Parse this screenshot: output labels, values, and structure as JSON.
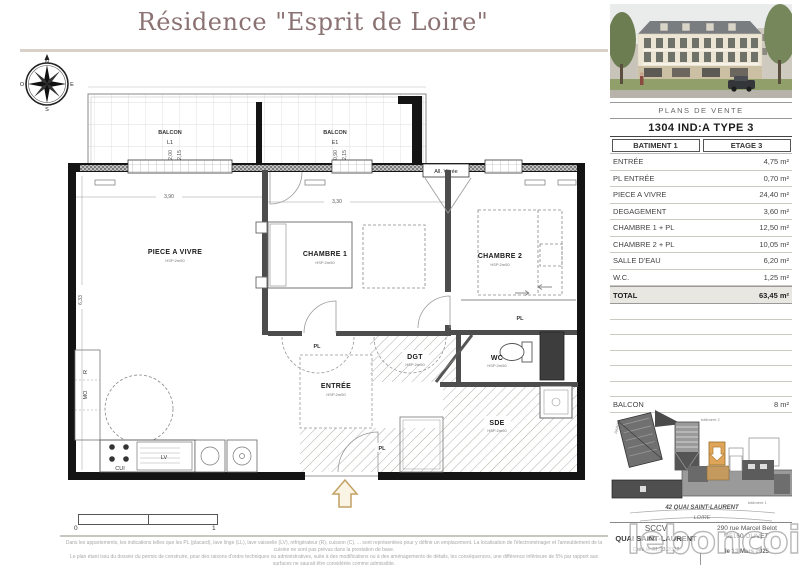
{
  "title": "Résidence \"Esprit de Loire\"",
  "compass": {
    "n": "N",
    "e": "E",
    "s": "S",
    "o": "O"
  },
  "plan": {
    "balcon_left": {
      "label": "BALCON",
      "code": "L1",
      "dim_a": "2,00",
      "dim_b": "2,15"
    },
    "balcon_right": {
      "label": "BALCON",
      "code": "E1",
      "dim_a": "0,90",
      "dim_b": "2,15"
    },
    "all_vitree": "All. Vitrée",
    "hsp": "HSP:2m50",
    "rooms": {
      "piece_a_vivre": "PIECE A VIVRE",
      "chambre1": "CHAMBRE 1",
      "chambre2": "CHAMBRE 2",
      "entree": "ENTRÉE",
      "dgt": "DGT",
      "wc": "WC",
      "sde": "SDE",
      "pl": "PL",
      "cui": "CUI",
      "lv": "LV",
      "mo": "MO",
      "r": "R"
    },
    "dims": {
      "d390": "3,90",
      "d633": "6,33",
      "d330": "3,30"
    }
  },
  "panel": {
    "header": "PLANS DE VENTE",
    "unit": "1304 IND:A TYPE 3",
    "batiment": "BATIMENT 1",
    "etage": "ETAGE 3",
    "rows": [
      {
        "label": "ENTRÉE",
        "value": "4,75 m²"
      },
      {
        "label": "PL ENTRÉE",
        "value": "0,70 m²"
      },
      {
        "label": "PIECE A VIVRE",
        "value": "24,40 m²"
      },
      {
        "label": "DEGAGEMENT",
        "value": "3,60 m²"
      },
      {
        "label": "CHAMBRE 1 + PL",
        "value": "12,50 m²"
      },
      {
        "label": "CHAMBRE 2 + PL",
        "value": "10,05 m²"
      },
      {
        "label": "SALLE D'EAU",
        "value": "6,20 m²"
      },
      {
        "label": "W.C.",
        "value": "1,25 m²"
      }
    ],
    "total": {
      "label": "TOTAL",
      "value": "63,45 m²"
    },
    "balcon": {
      "label": "BALCON",
      "value": "8 m²"
    },
    "map": {
      "parc": "PARC",
      "bat2": "bâtiment 2",
      "bat1": "bâtiment 1",
      "street": "42 QUAI SAINT-LAURENT",
      "river": "LOIRE"
    },
    "footer": {
      "company_line1": "SCCV",
      "company_line2": "QUAI SAINT-LAURENT",
      "address_line1": "290 rue Marcel Belot",
      "address_line2": "45160 OLIVET",
      "created": "Créé le 31.03.2022",
      "dated": "le 13 Mars 2025"
    }
  },
  "scale": {
    "start": "0",
    "end": "1"
  },
  "disclaimer": {
    "line1": "Dans les appartements, les indications telles que les PL (placard), lave linge (LL), lave vaisselle (LV), réfrigérateur (R), cuisson (C), ... sont représentées pour y définir un emplacement. La localisation de l'électroménager et l'ameublement de la cuisine ne sont pas prévus dans la prestation de base.",
    "line2": "Le plan étant issu du dossier du permis de construire, pour des raisons d'ordre techniques ou administratives, suite à des modifications ou à des aménagements de détails, les conséquences, une différence inférieure de 5% par rapport aux surfaces ne saurait être considérée comme admissible."
  },
  "watermark": "leboncoin",
  "colors": {
    "accent_tan": "#c9a266",
    "title": "#8b7272",
    "total_bg": "#e9e7e2"
  }
}
